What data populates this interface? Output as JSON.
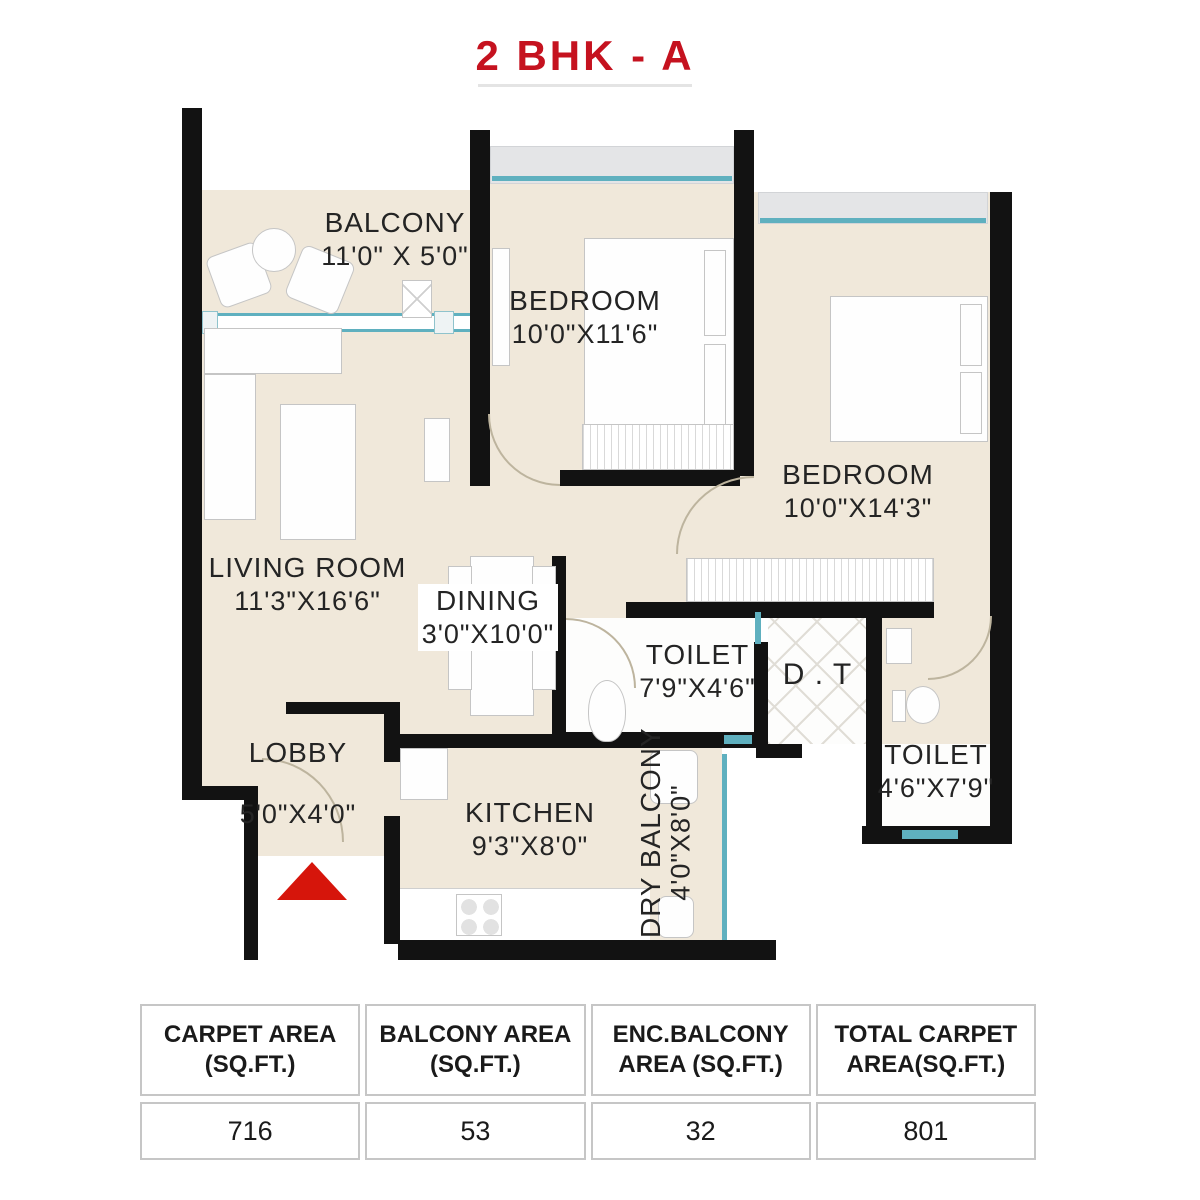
{
  "title": "2 BHK - A",
  "plan": {
    "rooms": [
      {
        "key": "balcony",
        "name": "BALCONY",
        "dims": "11'0\" X 5'0\""
      },
      {
        "key": "bedroom-1",
        "name": "BEDROOM",
        "dims": "10'0\"X11'6\""
      },
      {
        "key": "bedroom-2",
        "name": "BEDROOM",
        "dims": "10'0\"X14'3\""
      },
      {
        "key": "living-room",
        "name": "LIVING ROOM",
        "dims": "11'3\"X16'6\""
      },
      {
        "key": "dining",
        "name": "DINING",
        "dims": "3'0\"X10'0\""
      },
      {
        "key": "toilet-1",
        "name": "TOILET",
        "dims": "7'9\"X4'6\""
      },
      {
        "key": "duct",
        "name": "D . T",
        "dims": ""
      },
      {
        "key": "toilet-2",
        "name": "TOILET",
        "dims": "4'6\"X7'9\""
      },
      {
        "key": "lobby",
        "name": "LOBBY",
        "dims": "5'0\"X4'0\""
      },
      {
        "key": "kitchen",
        "name": "KITCHEN",
        "dims": "9'3\"X8'0\""
      },
      {
        "key": "dry-balcony",
        "name": "DRY BALCONY",
        "dims": "4'0\"X8'0\""
      }
    ]
  },
  "area_table": {
    "columns": [
      {
        "line1": "CARPET AREA",
        "line2": "(SQ.FT.)",
        "value": "716"
      },
      {
        "line1": "BALCONY AREA",
        "line2": "(SQ.FT.)",
        "value": "53"
      },
      {
        "line1": "ENC.BALCONY",
        "line2": "AREA (SQ.FT.)",
        "value": "32"
      },
      {
        "line1": "TOTAL CARPET",
        "line2": "AREA(SQ.FT.)",
        "value": "801"
      }
    ]
  },
  "colors": {
    "accent_red": "#c5121f",
    "entrance_red": "#d6150b",
    "wall_black": "#121212",
    "floor_beige": "#f0e8da",
    "window_cyan": "#5fb0bf",
    "sill_gray": "#e4e5e7"
  }
}
